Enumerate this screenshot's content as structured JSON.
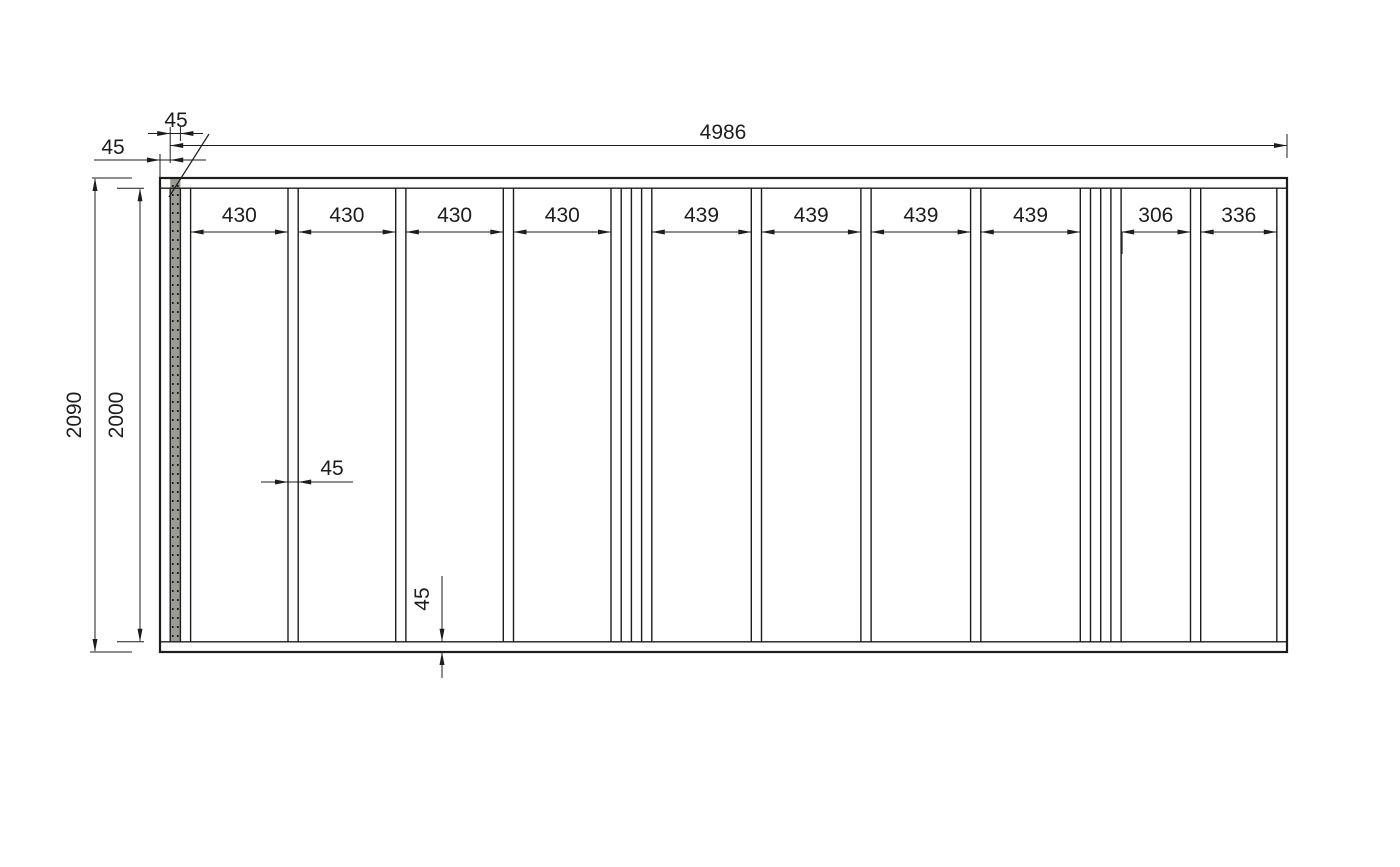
{
  "diagram": {
    "type": "wall-framing-elevation",
    "units": "mm",
    "colors": {
      "line": "#1d1d1d",
      "marked_stud_fill": "#9b9b94",
      "background": "#ffffff"
    },
    "dimension_labels": {
      "overall_width": "4986",
      "overall_height": "2090",
      "interior_height": "2000",
      "end_offset": "45",
      "end_stud_width": "45",
      "stud_width": "45",
      "bottom_plate_thickness": "45"
    },
    "bay_labels": [
      "430",
      "430",
      "430",
      "430",
      "439",
      "439",
      "439",
      "439",
      "306",
      "336"
    ],
    "geometry_mm": {
      "wall_width": 4986,
      "wall_height": 2090,
      "plate_thickness": 45,
      "stud_width": 45,
      "members": [
        {
          "x0": 0,
          "x1": 45,
          "type": "end-stud"
        },
        {
          "x0": 45,
          "x1": 90,
          "type": "marked-stud"
        },
        {
          "x0": 90,
          "x1": 135,
          "type": "stud"
        },
        {
          "x0": 565,
          "x1": 610,
          "type": "stud"
        },
        {
          "x0": 1040,
          "x1": 1085,
          "type": "stud"
        },
        {
          "x0": 1515,
          "x1": 1560,
          "type": "stud"
        },
        {
          "x0": 1990,
          "x1": 2035,
          "type": "stud"
        },
        {
          "x0": 2035,
          "x1": 2080,
          "type": "stud"
        },
        {
          "x0": 2080,
          "x1": 2125,
          "type": "stud"
        },
        {
          "x0": 2125,
          "x1": 2170,
          "type": "stud"
        },
        {
          "x0": 2609,
          "x1": 2654,
          "type": "stud"
        },
        {
          "x0": 3093,
          "x1": 3138,
          "type": "stud"
        },
        {
          "x0": 3577,
          "x1": 3622,
          "type": "stud"
        },
        {
          "x0": 4061,
          "x1": 4106,
          "type": "stud"
        },
        {
          "x0": 4106,
          "x1": 4151,
          "type": "stud"
        },
        {
          "x0": 4151,
          "x1": 4196,
          "type": "stud"
        },
        {
          "x0": 4196,
          "x1": 4241,
          "type": "stud"
        },
        {
          "x0": 4547,
          "x1": 4592,
          "type": "stud"
        },
        {
          "x0": 4928,
          "x1": 4973,
          "type": "end-stud"
        }
      ],
      "bays": [
        {
          "x0": 135,
          "x1": 565,
          "label": "430"
        },
        {
          "x0": 610,
          "x1": 1040,
          "label": "430"
        },
        {
          "x0": 1085,
          "x1": 1515,
          "label": "430"
        },
        {
          "x0": 1560,
          "x1": 1990,
          "label": "430"
        },
        {
          "x0": 2170,
          "x1": 2609,
          "label": "439"
        },
        {
          "x0": 2654,
          "x1": 3093,
          "label": "439"
        },
        {
          "x0": 3138,
          "x1": 3577,
          "label": "439"
        },
        {
          "x0": 3622,
          "x1": 4061,
          "label": "439"
        },
        {
          "x0": 4241,
          "x1": 4547,
          "label": "306"
        },
        {
          "x0": 4592,
          "x1": 4928,
          "label": "336"
        }
      ]
    }
  }
}
